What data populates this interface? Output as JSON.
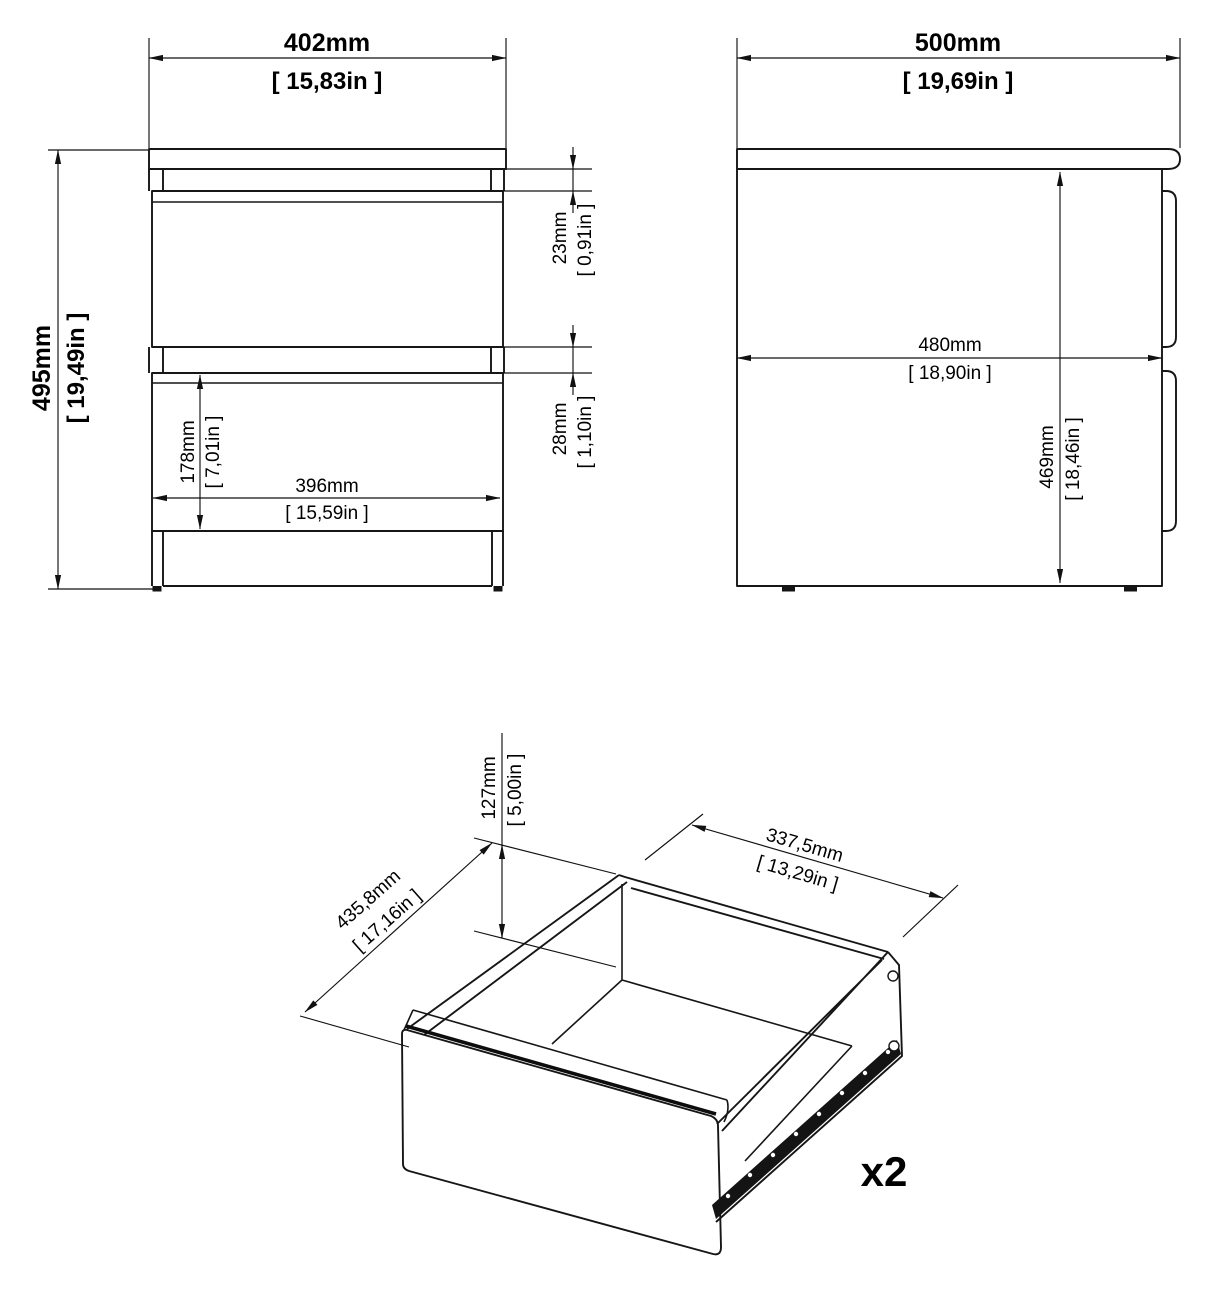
{
  "document": {
    "background": "#ffffff",
    "line_color": "#161616",
    "drawing_type": "furniture dimensional drawing, 2-drawer bedside chest"
  },
  "front_view": {
    "overall_width": {
      "mm": "402mm",
      "in": "[ 15,83in ]"
    },
    "overall_height": {
      "mm": "495mm",
      "in": "[ 19,49in ]"
    },
    "top_gap": {
      "mm": "23mm",
      "in": "[ 0,91in ]"
    },
    "between_drawers_gap": {
      "mm": "28mm",
      "in": "[ 1,10in ]"
    },
    "drawer_front_height": {
      "mm": "178mm",
      "in": "[ 7,01in ]"
    },
    "drawer_front_width": {
      "mm": "396mm",
      "in": "[ 15,59in ]"
    }
  },
  "side_view": {
    "overall_depth": {
      "mm": "500mm",
      "in": "[ 19,69in ]"
    },
    "internal_depth": {
      "mm": "480mm",
      "in": "[ 18,90in ]"
    },
    "internal_height": {
      "mm": "469mm",
      "in": "[ 18,46in ]"
    }
  },
  "drawer_view": {
    "internal_height": {
      "mm": "127mm",
      "in": "[ 5,00in ]"
    },
    "internal_width": {
      "mm": "337,5mm",
      "in": "[ 13,29in ]"
    },
    "internal_depth": {
      "mm": "435,8mm",
      "in": "[ 17,16in ]"
    },
    "quantity_label": "x2"
  }
}
